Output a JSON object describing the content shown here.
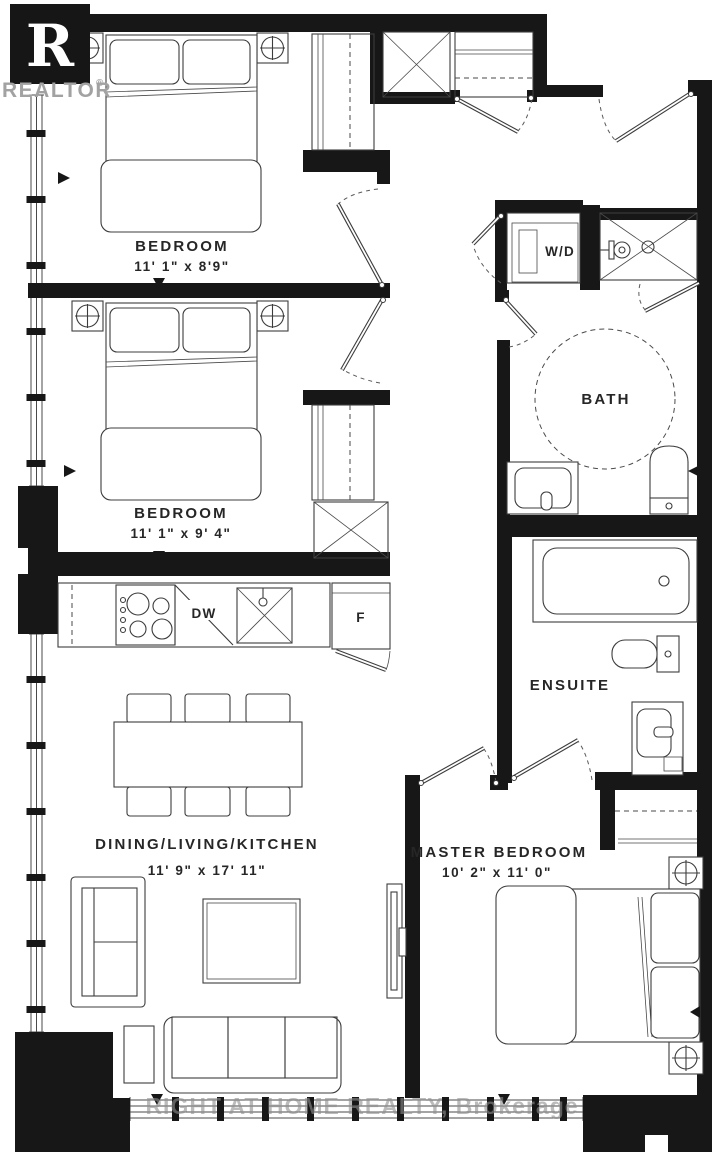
{
  "logo": {
    "letter": "R",
    "brand": "REALTOR",
    "reg": "®"
  },
  "rooms": {
    "bedroom1": {
      "name": "BEDROOM",
      "dims": "11' 1\" x 8'9\""
    },
    "bedroom2": {
      "name": "BEDROOM",
      "dims": "11' 1\" x 9' 4\""
    },
    "living": {
      "name": "DINING/LIVING/KITCHEN",
      "dims": "11' 9\" x 17' 11\""
    },
    "master": {
      "name": "MASTER BEDROOM",
      "dims": "10' 2\" x 11' 0\""
    },
    "bath": {
      "name": "BATH"
    },
    "ensuite": {
      "name": "ENSUITE"
    }
  },
  "appliances": {
    "washer_dryer": "W/D",
    "dishwasher": "DW",
    "fridge": "F"
  },
  "watermark": {
    "text": "RIGHT AT HOME REALTY, Brokerage"
  },
  "colors": {
    "wall": "#171717",
    "line": "#3c3c3c",
    "label": "#262626",
    "watermark": "#8f8f8f",
    "logo_gray": "#a2a2a2"
  }
}
